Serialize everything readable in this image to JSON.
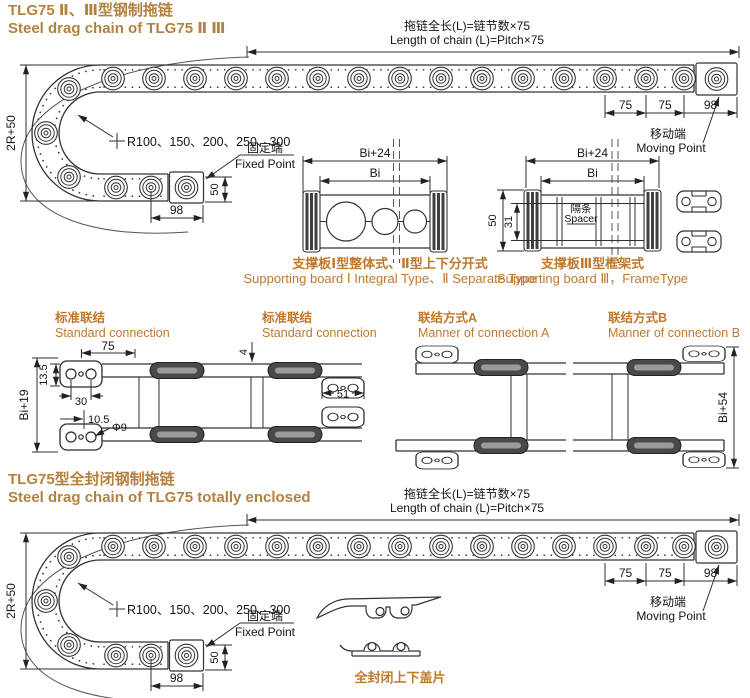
{
  "accent": {
    "title_color": "#b3823f",
    "caption_color": "#c1782a"
  },
  "section1": {
    "title_zh": "TLG75 Ⅱ、Ⅲ型钢制拖链",
    "title_en": "Steel drag chain of TLG75 Ⅱ Ⅲ"
  },
  "chain_diagram": {
    "length_note_zh": "拖链全长(L)=链节数×75",
    "length_note_en": "Length of chain (L)=Pitch×75",
    "dim_pitch_a": "75",
    "dim_pitch_b": "75",
    "dim_end": "98",
    "dim_height": "2R+50",
    "radii_note": "R100、150、200、250、300",
    "moving_zh": "移动端",
    "moving_en": "Moving Point",
    "fixed_zh": "固定端",
    "fixed_en": "Fixed Point",
    "dim_fixed_h": "50",
    "dim_fixed_w": "98"
  },
  "cross_section_1": {
    "dim_outer": "Bi+24",
    "dim_inner": "Bi",
    "caption_zh": "支撑板Ⅰ型整体式、Ⅱ型上下分开式",
    "caption_en": "Supporting board Ⅰ Integral Type、Ⅱ Separate Type"
  },
  "cross_section_3": {
    "dim_outer": "Bi+24",
    "dim_inner": "Bi",
    "dim_height": "50",
    "dim_inner_height": "31",
    "spacer_zh": "隔条",
    "spacer_en": "Spacer",
    "caption_zh": "支撑板Ⅲ型框架式",
    "caption_en": "Supporting board Ⅲ，FrameType"
  },
  "connections": {
    "standard_a": {
      "label_zh": "标准联结",
      "label_en": "Standard connection",
      "dim_pitch": "75",
      "dim_plate": "13.5",
      "dim_holes": "30",
      "dim_height": "Bi+19",
      "dim_offset": "10.5",
      "dim_hole_dia": "Φ9"
    },
    "standard_b": {
      "label_zh": "标准联结",
      "label_en": "Standard connection",
      "dim_thickness": "4",
      "dim_span": "51"
    },
    "manner_a": {
      "label_zh": "联结方式A",
      "label_en": "Manner of connection A"
    },
    "manner_b": {
      "label_zh": "联结方式B",
      "label_en": "Manner of connection B",
      "dim_height": "Bi+54"
    }
  },
  "section2": {
    "title_zh": "TLG75型全封闭钢制拖链",
    "title_en": "Steel drag chain of TLG75 totally enclosed",
    "cover_label_zh": "全封闭上下盖片"
  }
}
